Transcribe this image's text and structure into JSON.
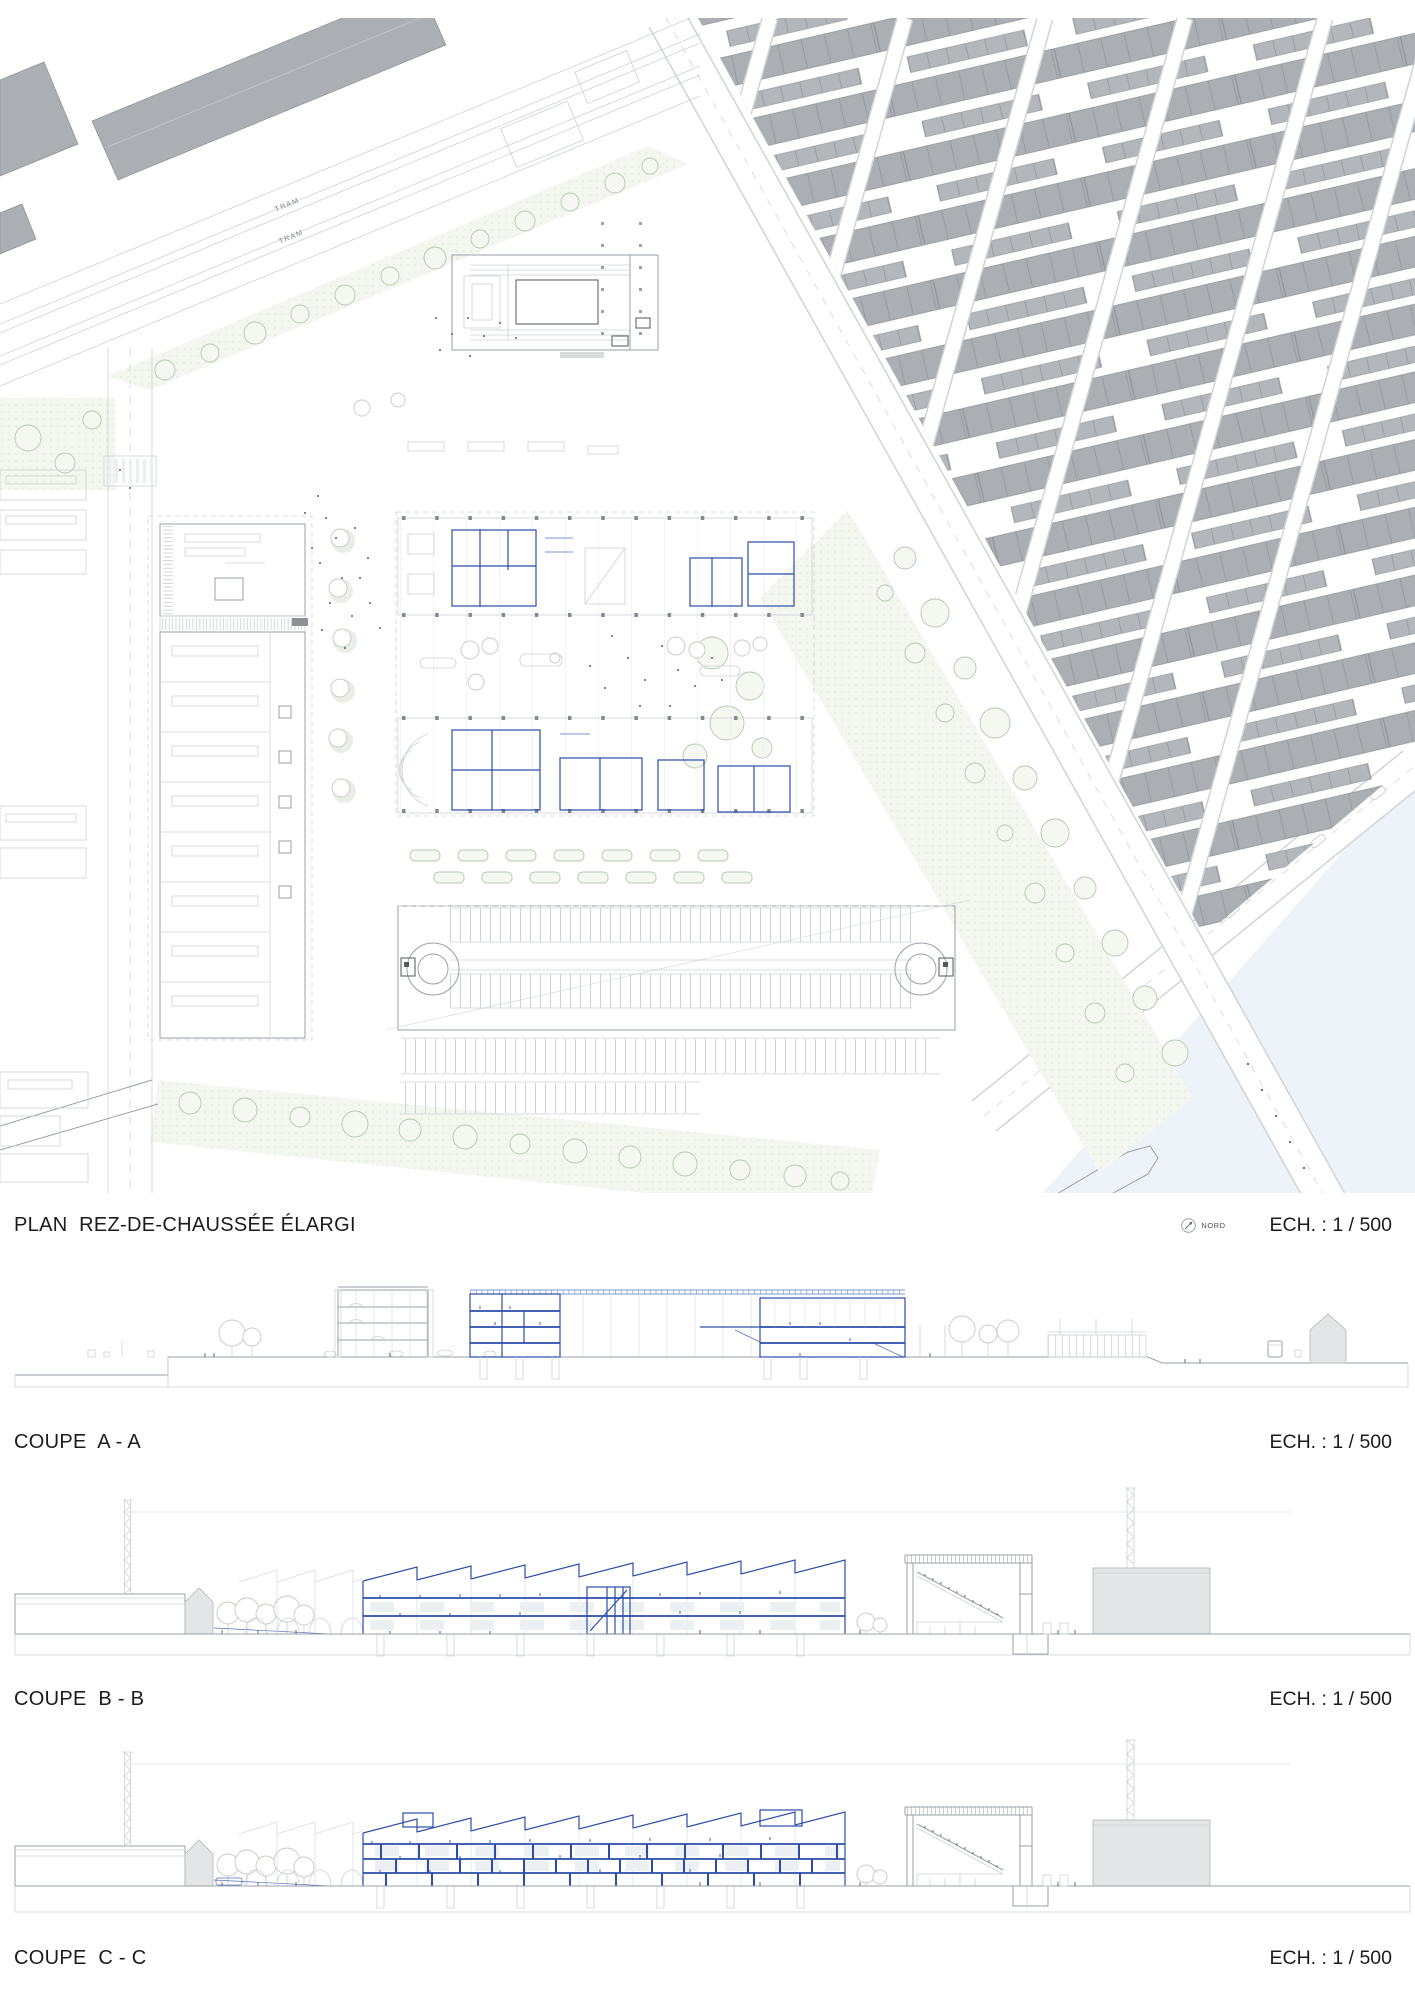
{
  "plan": {
    "title": "PLAN  REZ-DE-CHAUSSÉE ÉLARGI",
    "north_label": "NORD",
    "scale_label": "ECH. : 1 / 500",
    "tram_label": "TRAM"
  },
  "sections": [
    {
      "title": "COUPE  A - A",
      "scale_label": "ECH. : 1 / 500"
    },
    {
      "title": "COUPE  B - B",
      "scale_label": "ECH. : 1 / 500"
    },
    {
      "title": "COUPE  C - C",
      "scale_label": "ECH. : 1 / 500"
    }
  ],
  "colors": {
    "text": "#1c1c1c",
    "line-gray": "#9aa0a6",
    "line-light": "#cdd2d6",
    "building-gray": "#abaeb3",
    "building-edge": "#8d9196",
    "building-light": "#e3e5e7",
    "project-blue": "#2a4da9",
    "green-fill": "#f3f7ef",
    "tree-stroke": "#b5c8ae",
    "water": "#edf3f9"
  }
}
